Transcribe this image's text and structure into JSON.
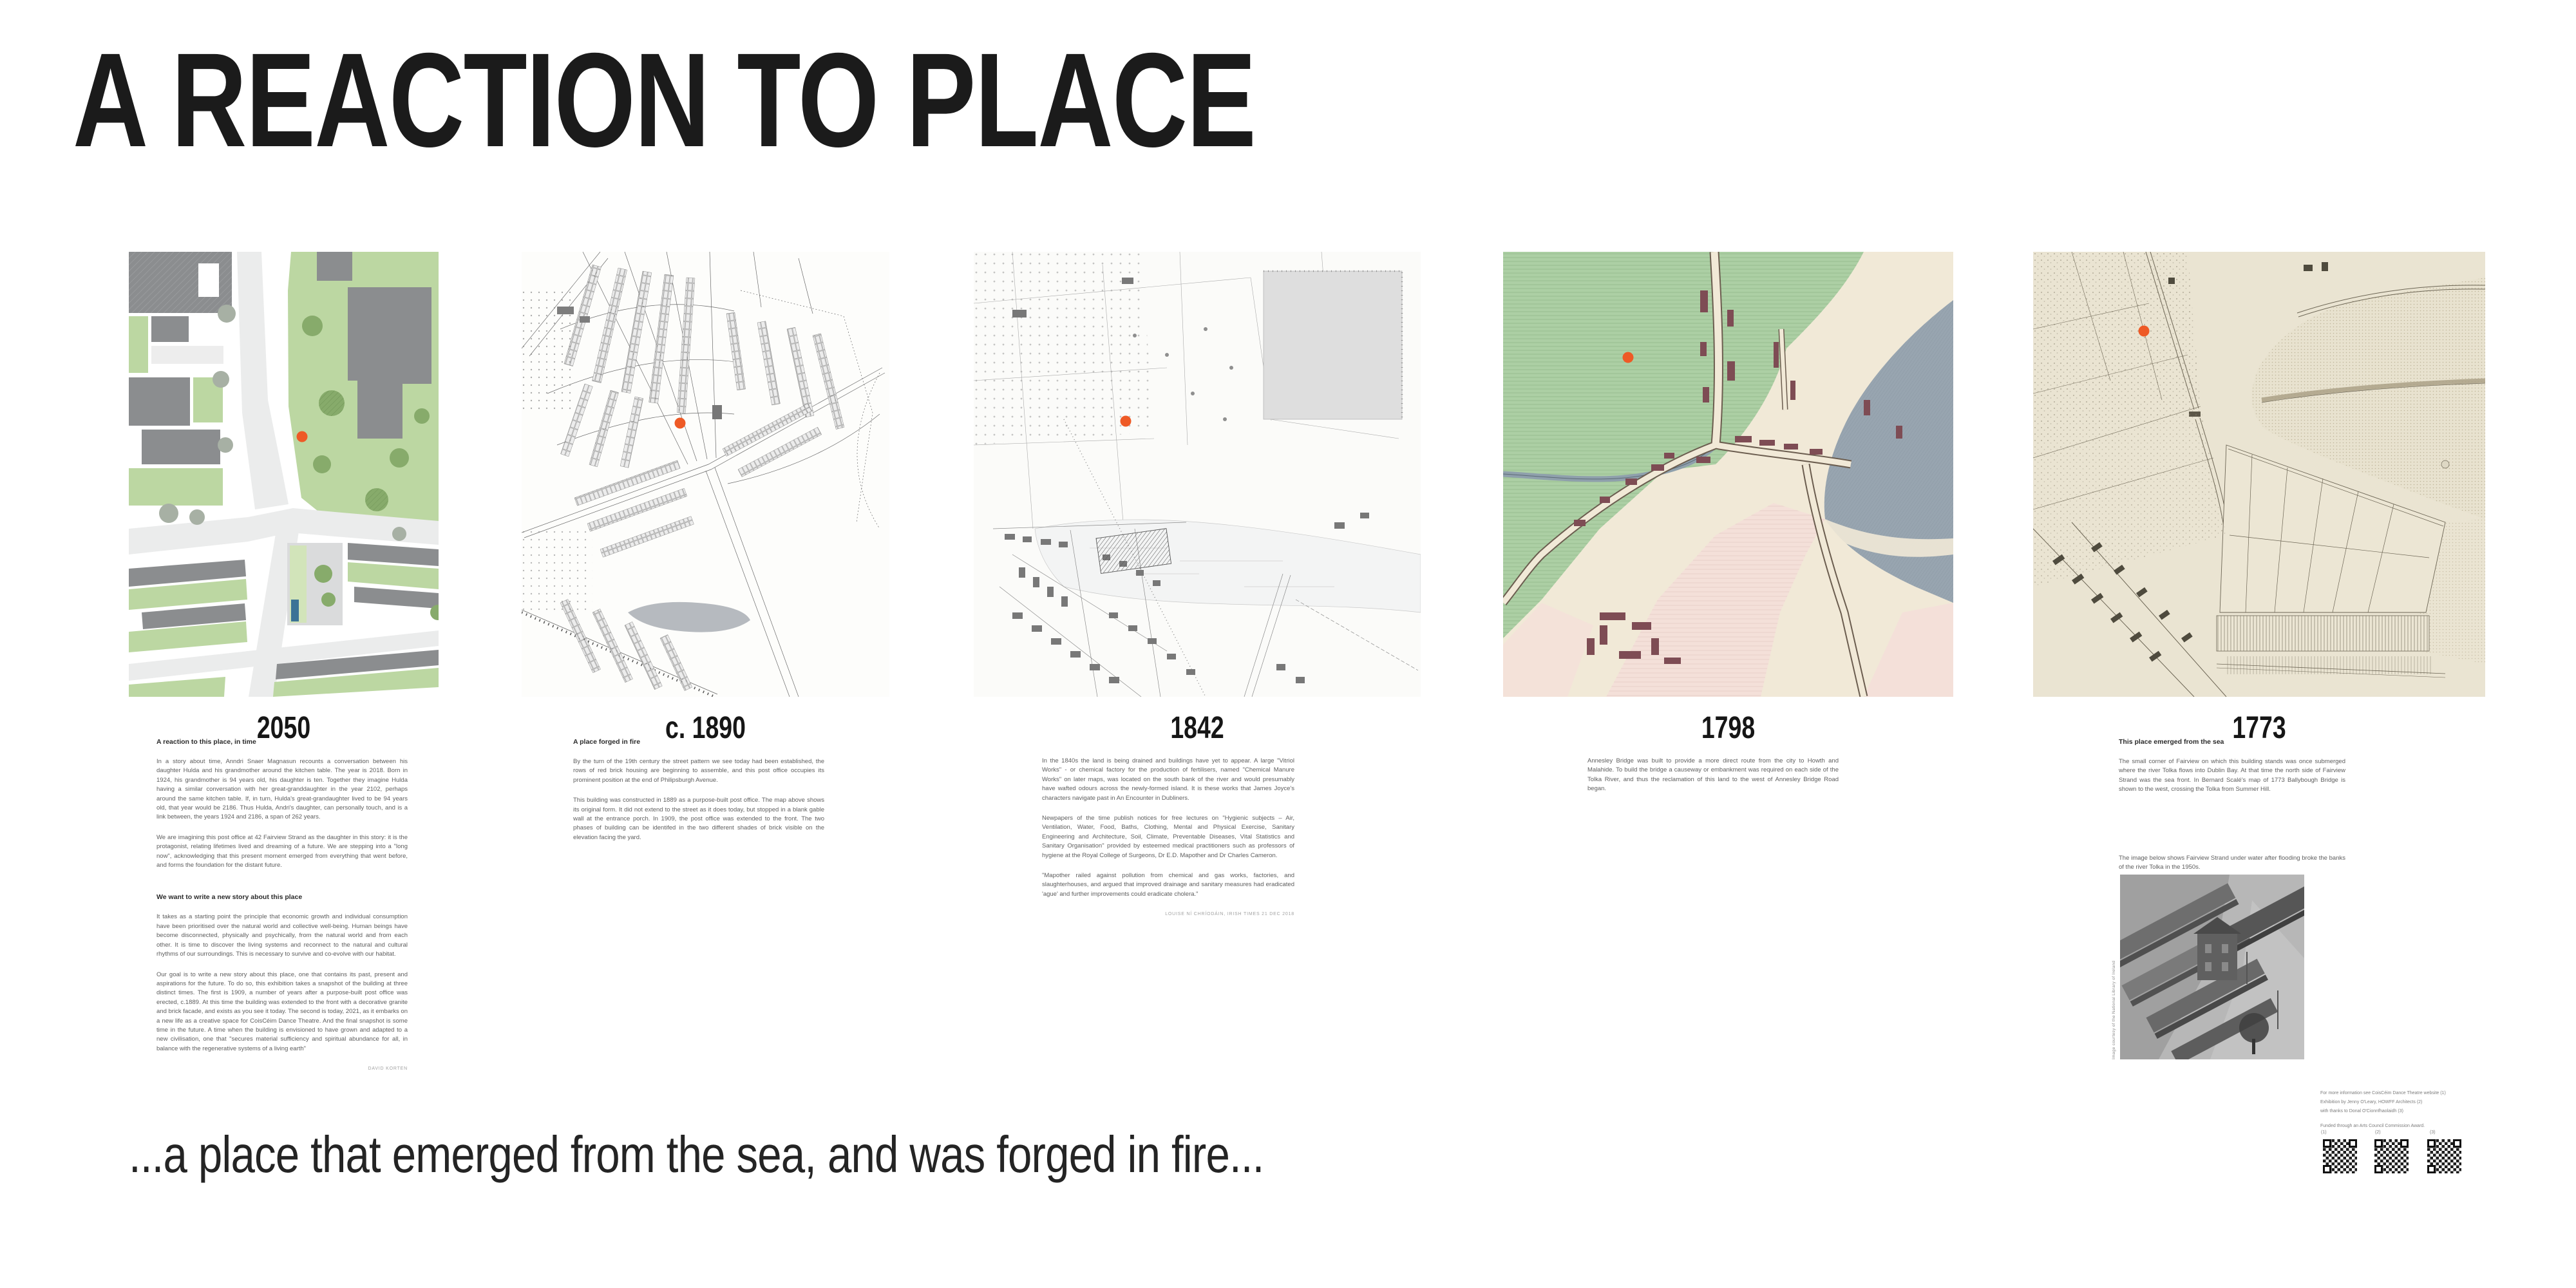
{
  "page": {
    "title": "A REACTION TO PLACE",
    "tagline": "...a place that emerged from the sea, and was forged in fire..."
  },
  "theme": {
    "accent_marker": "#ee5a26",
    "title_color": "#1b1b1b",
    "heading_color": "#2b2b2b",
    "body_color": "#5d5d5d",
    "attribution_color": "#a2a2a2",
    "caption_color": "#8c8c8c",
    "m1_green": "#bcd7a2",
    "m1_green_light": "#d2e4ba",
    "m1_building": "#8b8d8f",
    "m1_road": "#ebecec",
    "m1_paving": "#dadbdc",
    "m1_tree": "#87ab6b",
    "m1_tree_gray": "#a7b0a4",
    "m1_water": "#3c7396",
    "m4_green": "#accfa4",
    "m4_water": "#98a5b0",
    "m4_pink": "#f4e0d9",
    "m4_cream": "#f1e9d7",
    "m4_building": "#7e4c54",
    "m5_parchment": "#eae4d2"
  },
  "panels": [
    {
      "year_label": "2050",
      "map": {
        "name": "site-plan-2050",
        "labels": []
      },
      "sections": [
        {
          "heading": "A reaction to this place, in time",
          "paragraphs": [
            "In a story about time, Anndri Snaer Magnasun recounts a conversation between his daughter Hulda and his grandmother around the kitchen table.  The year is 2018. Born in 1924, his grandmother is 94 years old, his daughter is ten.  Together they imagine Hulda having a similar conversation with her great-granddaughter in the year 2102, perhaps around the same kitchen table.  If, in turn, Hulda's great-grandaughter lived to be 94 years old, that year would be 2186. Thus Hulda, Andri's daughter, can personally touch, and is a link between, the years 1924 and 2186, a span of 262 years.",
            "We are imagining this post office at 42 Fairview Strand as the daughter in this story: it is the protagonist, relating lifetimes lived and dreaming of a future. We are stepping into a \"long now\", acknowledging that this present moment emerged from everything that went before, and forms the foundation for the distant future."
          ]
        },
        {
          "heading": "We want to write a new story about this place",
          "paragraphs": [
            "It takes as a starting point the principle that economic growth and individual consumption have been prioritised over the natural world and collective well-being.  Human beings have become disconnected, physically and psychically, from the natural world and from each other.  It is time to discover the living systems and reconnect to the natural and cultural rhythms of our surroundings. This is necessary to survive and co-evolve with our habitat.",
            "Our goal is to write a new story about this place,  one that contains its past, present and aspirations for the future. To do so, this exhibition takes a snapshot of the building at three distinct times. The first is 1909, a number of years after a purpose-built post office was erected, c.1889.  At this time the building was extended to the front with a decorative granite and brick facade, and exists as you see it today.  The second is today, 2021, as it embarks on a new life as a creative space for CoisCéim Dance Theatre.  And the final snapshot is some time in the future. A time when the building is envisioned to have grown and adapted to a new civilisation, one that \"secures material sufficiency and spiritual abundance for all, in balance with the regenerative systems of a living earth\""
          ],
          "attribution": "DAVID KORTEN"
        }
      ]
    },
    {
      "year_label": "c. 1890",
      "map": {
        "name": "ordnance-survey-map-1890",
        "labels": [
          {
            "text": "St Vincent's",
            "x": 9,
            "y": 10.5,
            "size": 8,
            "style": "italic"
          },
          {
            "text": "Lunatic Asylum",
            "x": 8,
            "y": 12.5,
            "size": 8,
            "style": "italic"
          },
          {
            "text": "Croydon",
            "x": 53,
            "y": 5,
            "size": 8,
            "style": "italic"
          },
          {
            "text": "Cottages",
            "x": 54,
            "y": 7,
            "size": 8,
            "style": "italic"
          },
          {
            "text": "Annadale",
            "x": 50,
            "y": 12,
            "size": 7,
            "style": "italic"
          },
          {
            "text": "House",
            "x": 52,
            "y": 14,
            "size": 7,
            "style": "italic"
          },
          {
            "text": "St. Mary's",
            "x": 55,
            "y": 42,
            "size": 8,
            "style": "italic"
          },
          {
            "text": "R.C. Church",
            "x": 55,
            "y": 44,
            "size": 8,
            "style": "italic"
          },
          {
            "text": "Ballybough",
            "x": 29,
            "y": 57.5,
            "size": 8,
            "style": "italic"
          },
          {
            "text": "Bridge",
            "x": 31,
            "y": 59.5,
            "size": 8,
            "style": "italic"
          },
          {
            "text": "Annesley Bridge",
            "x": 57,
            "y": 69,
            "size": 8,
            "style": "italic"
          },
          {
            "text": "Mud",
            "x": 83,
            "y": 69,
            "size": 11,
            "style": "italic"
          },
          {
            "text": "S",
            "x": 6,
            "y": 53,
            "size": 24,
            "style": "italic",
            "weight": "bold"
          }
        ]
      },
      "sections": [
        {
          "heading": "A place forged in fire",
          "paragraphs": [
            "By the turn of the 19th century the street pattern we see today had been established, the rows of red brick housing are beginning to assemble, and this post office occupies its prominent position at the end of Philipsburgh Avenue.",
            "This building was constructed in 1889 as a purpose-built post office. The map above shows its original form. It did not extend to the street as it does today, but stopped in a blank gable wall at the entrance porch. In 1909, the post office was extended to the front. The two phases of building can be identifed in the two different shades of brick visible on the elevation facing the yard."
          ]
        }
      ]
    },
    {
      "year_label": "1842",
      "map": {
        "name": "valuation-map-1842",
        "labels": [
          {
            "text": "Richmond Ho.",
            "x": 6,
            "y": 11,
            "size": 9,
            "style": "italic"
          },
          {
            "text": "Annadale Ho.",
            "x": 28,
            "y": 2,
            "size": 9,
            "style": "italic"
          },
          {
            "text": "Eldon Park",
            "x": 49,
            "y": 1,
            "size": 9,
            "style": "italic"
          },
          {
            "text": "Cataldo",
            "x": 32,
            "y": 22,
            "size": 9,
            "style": "italic"
          },
          {
            "text": "Laburnum",
            "x": 34,
            "y": 32,
            "size": 9,
            "style": "italic"
          },
          {
            "text": "Lodge",
            "x": 37,
            "y": 34.5,
            "size": 9,
            "style": "italic"
          },
          {
            "text": "12 swamp",
            "x": 66,
            "y": 7,
            "size": 8,
            "style": "italic"
          },
          {
            "text": "34",
            "x": 71,
            "y": 3.5,
            "size": 11,
            "style": "italic"
          },
          {
            "text": "R.C. Chapel",
            "x": 83,
            "y": 38,
            "size": 8,
            "style": "italic"
          },
          {
            "text": "Post Office",
            "x": 76,
            "y": 43.5,
            "size": 9,
            "style": "italic"
          },
          {
            "text": "PHILLIPSBURG STRAND",
            "x": 45,
            "y": 50,
            "size": 5,
            "ls": 1
          },
          {
            "text": "Ballybough Br.",
            "x": 7,
            "y": 60,
            "size": 9,
            "style": "italic"
          },
          {
            "text": "Gravel Pit",
            "x": 1,
            "y": 65.5,
            "size": 8,
            "style": "italic"
          },
          {
            "text": "Vitriol Works",
            "x": 34,
            "y": 62,
            "size": 10,
            "style": "italic"
          },
          {
            "text": "Annesley Br.",
            "x": 55,
            "y": 76,
            "size": 9,
            "style": "italic"
          }
        ]
      },
      "sections": [
        {
          "heading": "",
          "paragraphs": [
            "In the 1840s the land is being drained and buildings have yet to appear.  A large \"Vitriol Works\" -  or chemical factory for the production of fertilisers, named \"Chemical Manure Works\" on later maps,  was located on the south bank of the river and would presumably have wafted odours across the newly-formed island. It is these works that James Joyce's characters navigate past in An Encounter in Dubliners.",
            "Newpapers of the time publish notices for free lectures on \"Hygienic subjects – Air, Ventilation, Water, Food, Baths, Clothing, Mental and Physical Exercise, Sanitary Engineering and Architecture, Soil, Climate, Preventable Diseases, Vital Statistics and Sanitary Organisation\" provided by esteemed medical practitioners such as professors of hygiene at the Royal College of Surgeons, Dr E.D. Mapother and Dr Charles Cameron.",
            "\"Mapother railed against pollution from chemical and gas works, factories, and slaughterhouses, and argued that improved drainage and sanitary measures had eradicated 'ague' and further improvements could eradicate cholera.\""
          ],
          "attribution": "LOUISE NÍ CHRÍODÁIN, IRISH TIMES 21 DEC 2018"
        }
      ]
    },
    {
      "year_label": "1798",
      "map": {
        "name": "colour-map-1798",
        "labels": [
          {
            "text": "RICHMOND",
            "x": 7,
            "y": 13,
            "size": 13,
            "ls": 3
          },
          {
            "text": "BALLYBOUGH",
            "x": 16,
            "y": 25.5,
            "size": 10,
            "ls": 2
          },
          {
            "text": "BRIDGE",
            "x": 20.5,
            "y": 28.5,
            "size": 10,
            "ls": 2
          },
          {
            "text": "Mari",
            "x": 88,
            "y": 3,
            "size": 15
          },
          {
            "text": "Fair View",
            "x": 63,
            "y": 25,
            "size": 9,
            "rot": -90
          },
          {
            "text": "COVERED",
            "x": 62,
            "y": 56,
            "size": 26,
            "style": "italic",
            "ls": 7
          },
          {
            "text": "Annesley Br.",
            "x": 41,
            "y": 60,
            "size": 9,
            "rot": -70,
            "style": "italic"
          },
          {
            "text": "ricks Lane",
            "x": 0,
            "y": 36,
            "size": 9,
            "rot": -32,
            "style": "italic"
          },
          {
            "text": "N",
            "x": 16,
            "y": 80,
            "size": 18,
            "style": "italic"
          },
          {
            "text": "Br.",
            "x": 1,
            "y": 87,
            "size": 10
          }
        ]
      },
      "sections": [
        {
          "heading": "",
          "paragraphs": [
            "Annesley Bridge was built to provide a more direct route from the city to Howth and Malahide.  To build the bridge a causeway or embankment was required on each side of the Tolka River, and thus the reclamation of this land to the west of Annesley Bridge Road began."
          ]
        }
      ]
    },
    {
      "year_label": "1773",
      "map": {
        "name": "scale-map-1773",
        "labels": [
          {
            "text": "Royal Charter",
            "x": 60,
            "y": 0.5,
            "size": 8
          },
          {
            "text": "School",
            "x": 64,
            "y": 5.5,
            "size": 8,
            "style": "italic"
          },
          {
            "text": "N O R T H",
            "x": 58,
            "y": 9,
            "size": 11,
            "ls": 4,
            "style": "italic"
          },
          {
            "text": "S",
            "x": 93,
            "y": 9,
            "size": 11,
            "style": "italic"
          },
          {
            "text": "Ballybough River",
            "x": 49,
            "y": 21.5,
            "size": 9,
            "style": "italic"
          },
          {
            "text": "Ballybough",
            "x": 19,
            "y": 25,
            "size": 9,
            "rot": -20,
            "style": "italic"
          },
          {
            "text": "Bridge",
            "x": 30,
            "y": 27.5,
            "size": 9,
            "style": "italic"
          },
          {
            "text": "Clontarf",
            "x": 74,
            "y": 35,
            "size": 10,
            "style": "italic"
          },
          {
            "text": "Island House",
            "x": 83,
            "y": 44,
            "size": 7,
            "style": "italic"
          },
          {
            "text": "T H E   N O R T H",
            "x": 31,
            "y": 64,
            "size": 10,
            "style": "italic",
            "ls": 3,
            "rot": 9
          },
          {
            "text": "L O T S",
            "x": 55,
            "y": 78,
            "size": 10,
            "style": "italic",
            "ls": 3
          },
          {
            "text": "HORSE ROAD TO RINGSEND",
            "x": 48,
            "y": 86,
            "size": 5,
            "ls": 1
          },
          {
            "text": "THE SOUTH",
            "x": 48,
            "y": 93,
            "size": 8,
            "ls": 3,
            "style": "italic"
          },
          {
            "text": "LOTS",
            "x": 55,
            "y": 97.5,
            "size": 8,
            "ls": 3,
            "style": "italic"
          },
          {
            "text": "RINGS END",
            "x": 86,
            "y": 88,
            "size": 7,
            "ls": 1
          }
        ]
      },
      "sections": [
        {
          "heading": "This place emerged from the sea",
          "paragraphs": [
            "The small corner of Fairview on which this building stands was once submerged where the river Tolka flows into Dublin Bay.  At that time the north side of Fairview Strand was the sea front.  In Bernard Scalé's map of 1773 Ballybough Bridge is shown to the west, crossing the Tolka from Summer Hill."
          ]
        },
        {
          "heading": "",
          "paragraphs": [
            "The image below shows Fairview Strand under water after flooding broke the banks of the river Tolka in the 1950s."
          ]
        }
      ],
      "photo": {
        "credit": "Image courtesy of the National Library of Ireland"
      },
      "credits": {
        "lines": [
          "For more information see CoisCéim Dance Theatre website (1)",
          "Exhibition by Jenny O'Leary, HOWFF Architects (2)",
          "with thanks to Donal O'Cionnfhaolaidh (3)"
        ],
        "funding": "Funded through an Arts Council Commission Award.",
        "qr_labels": [
          "(1)",
          "(2)",
          "(3)"
        ]
      }
    }
  ]
}
